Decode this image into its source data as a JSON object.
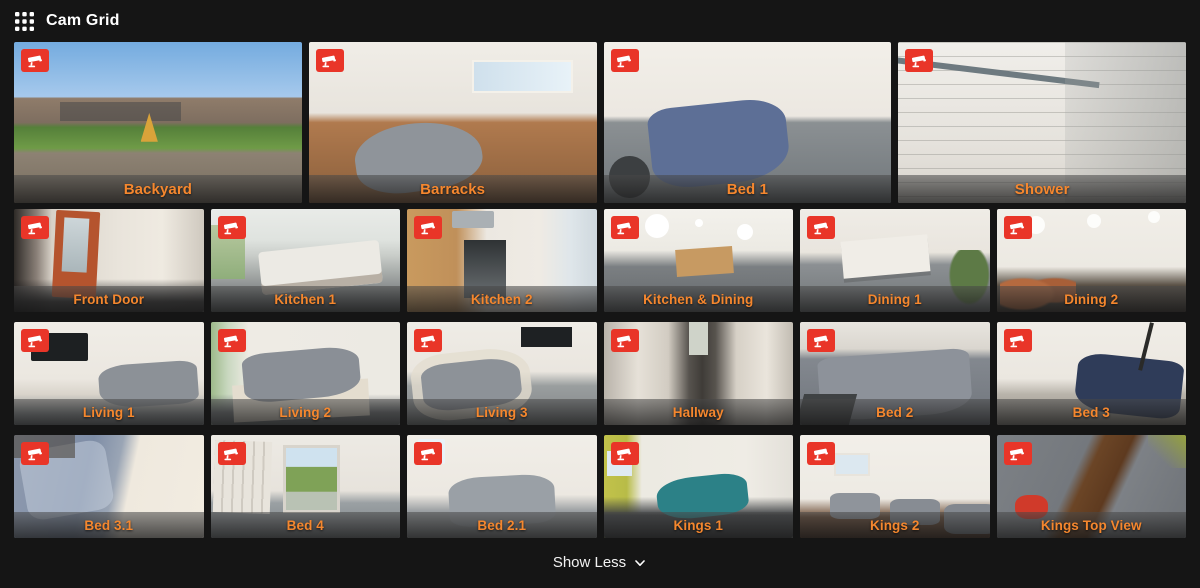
{
  "header": {
    "title": "Cam Grid"
  },
  "footer": {
    "show_less_label": "Show Less"
  },
  "colors": {
    "page_bg": "#151515",
    "header_text": "#ffffff",
    "camera_label": "#f5872e",
    "badge_red": "#e93528",
    "footer_text": "#f2f2f2"
  },
  "icons": {
    "header": "grid-icon",
    "tile_badge": "cctv-camera-icon",
    "footer": "chevron-down-icon"
  },
  "rows": [
    {
      "cameras": [
        {
          "label": "Backyard",
          "scene": "backyard"
        },
        {
          "label": "Barracks",
          "scene": "barracks"
        },
        {
          "label": "Bed 1",
          "scene": "bed1"
        },
        {
          "label": "Shower",
          "scene": "shower"
        }
      ]
    },
    {
      "cameras": [
        {
          "label": "Front Door",
          "scene": "frontdoor"
        },
        {
          "label": "Kitchen 1",
          "scene": "kitchen1"
        },
        {
          "label": "Kitchen 2",
          "scene": "kitchen2"
        },
        {
          "label": "Kitchen & Dining",
          "scene": "kitchendining"
        },
        {
          "label": "Dining 1",
          "scene": "dining1"
        },
        {
          "label": "Dining 2",
          "scene": "dining2"
        }
      ]
    },
    {
      "cameras": [
        {
          "label": "Living 1",
          "scene": "living1"
        },
        {
          "label": "Living 2",
          "scene": "living2"
        },
        {
          "label": "Living 3",
          "scene": "living3"
        },
        {
          "label": "Hallway",
          "scene": "hallway"
        },
        {
          "label": "Bed 2",
          "scene": "bed2"
        },
        {
          "label": "Bed 3",
          "scene": "bed3"
        }
      ]
    },
    {
      "cameras": [
        {
          "label": "Bed 3.1",
          "scene": "bed31"
        },
        {
          "label": "Bed 4",
          "scene": "bed4"
        },
        {
          "label": "Bed 2.1",
          "scene": "bed21"
        },
        {
          "label": "Kings 1",
          "scene": "kings1"
        },
        {
          "label": "Kings 2",
          "scene": "kings2"
        },
        {
          "label": "Kings Top View",
          "scene": "kingstop"
        }
      ]
    }
  ]
}
